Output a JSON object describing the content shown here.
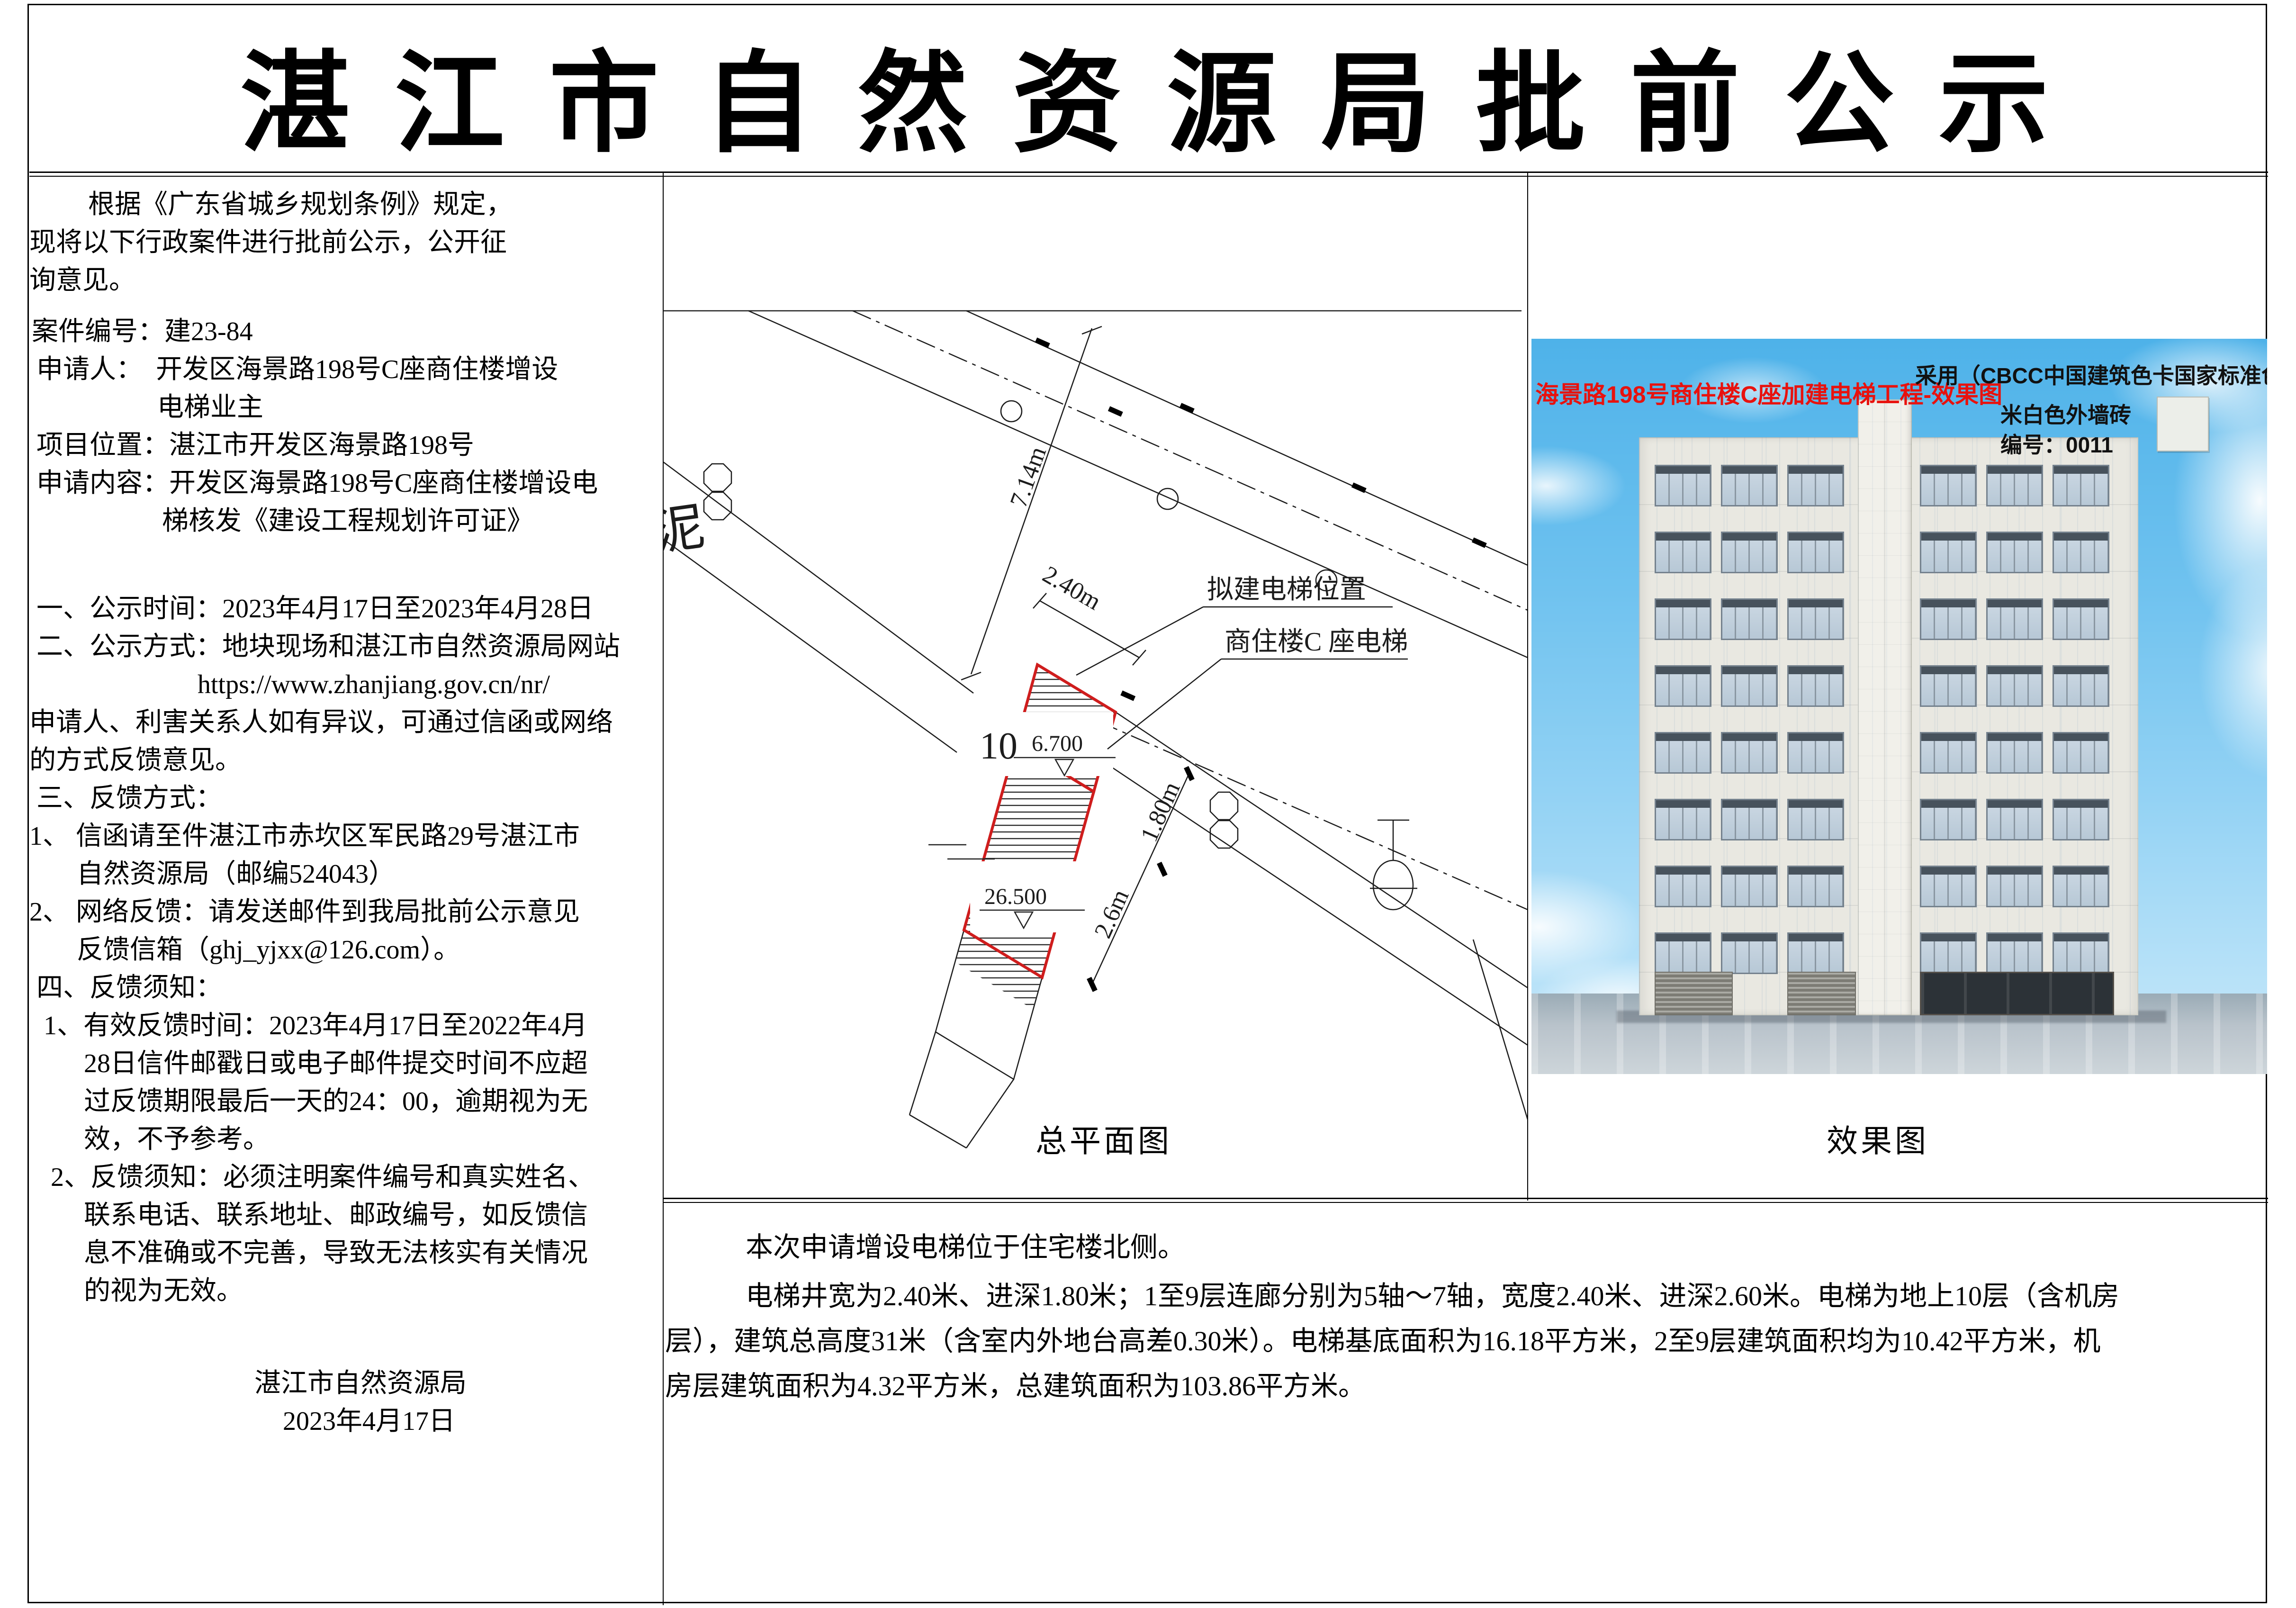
{
  "page": {
    "title": "湛 江 市 自 然 资 源 局 批 前 公 示"
  },
  "left_panel": {
    "lines": [
      {
        "t": "根据《广东省城乡规划条例》规定，",
        "ind": 124,
        "gap": 0
      },
      {
        "t": "现将以下行政案件进行批前公示，公开征",
        "ind": 0,
        "gap": 0
      },
      {
        "t": "询意见。",
        "ind": 0,
        "gap": 0
      },
      {
        "t": "案件编号：建23-84",
        "ind": 5,
        "gap": 28
      },
      {
        "t": "申请人：　开发区海景路198号C座商住楼增设",
        "ind": 15,
        "gap": 0
      },
      {
        "t": "电梯业主",
        "ind": 270,
        "gap": 0
      },
      {
        "t": "项目位置：湛江市开发区海景路198号",
        "ind": 15,
        "gap": 0
      },
      {
        "t": "申请内容：开发区海景路198号C座商住楼增设电",
        "ind": 15,
        "gap": 0
      },
      {
        "t": "梯核发《建设工程规划许可证》",
        "ind": 280,
        "gap": 0
      },
      {
        "t": "一、公示时间：2023年4月17日至2023年4月28日",
        "ind": 15,
        "gap": 105
      },
      {
        "t": "二、公示方式：地块现场和湛江市自然资源局网站",
        "ind": 15,
        "gap": 0
      },
      {
        "t": "https://www.zhanjiang.gov.cn/nr/",
        "ind": 355,
        "gap": 0
      },
      {
        "t": "申请人、利害关系人如有异议，可通过信函或网络",
        "ind": 0,
        "gap": 0
      },
      {
        "t": "的方式反馈意见。",
        "ind": 0,
        "gap": 0
      },
      {
        "t": "三、反馈方式：",
        "ind": 15,
        "gap": 0
      },
      {
        "t": "1、 信函请至件湛江市赤坎区军民路29号湛江市",
        "ind": 0,
        "gap": 0
      },
      {
        "t": "自然资源局（邮编524043）",
        "ind": 100,
        "gap": 0
      },
      {
        "t": "2、 网络反馈：请发送邮件到我局批前公示意见",
        "ind": 0,
        "gap": 0
      },
      {
        "t": "反馈信箱（ghj_yjxx@126.com）。",
        "ind": 100,
        "gap": 0
      },
      {
        "t": "四、反馈须知：",
        "ind": 15,
        "gap": 0
      },
      {
        "t": "1、有效反馈时间：2023年4月17日至2022年4月",
        "ind": 30,
        "gap": 0
      },
      {
        "t": "28日信件邮戳日或电子邮件提交时间不应超",
        "ind": 115,
        "gap": 0
      },
      {
        "t": "过反馈期限最后一天的24：00，逾期视为无",
        "ind": 115,
        "gap": 0
      },
      {
        "t": "效，不予参考。",
        "ind": 115,
        "gap": 0
      },
      {
        "t": "2、反馈须知：必须注明案件编号和真实姓名、",
        "ind": 45,
        "gap": 0
      },
      {
        "t": "联系电话、联系地址、邮政编号，如反馈信",
        "ind": 115,
        "gap": 0
      },
      {
        "t": "息不准确或不完善，导致无法核实有关情况",
        "ind": 115,
        "gap": 0
      },
      {
        "t": "的视为无效。",
        "ind": 115,
        "gap": 0
      },
      {
        "t": "湛江市自然资源局",
        "ind": 475,
        "gap": 115
      },
      {
        "t": "2023年4月17日",
        "ind": 535,
        "gap": 0
      }
    ]
  },
  "site_plan": {
    "caption": "总平面图",
    "cement_label": "泥",
    "label_elevator_location": "拟建电梯位置",
    "label_building_elevator": "商住楼C 座电梯",
    "dim_714": "7.14m",
    "dim_240": "2.40m",
    "dim_180": "1.80m",
    "dim_26": "2.6m",
    "floors_num": "10",
    "level_6700": "6.700",
    "level_26500": "26.500"
  },
  "rendering": {
    "caption": "效果图",
    "red_title": "海景路198号商住楼C座加建电梯工程-效果图",
    "color_note": "采用（CBCC中国建筑色卡国家标准色卡0011色）",
    "wall_note": "米白色外墙砖",
    "code_note": "编号：0011",
    "colors": {
      "sky": "#4eb2e9",
      "wall": "#e9e8e1",
      "accent_red": "#e8120e",
      "plan_red": "#cf1d1d"
    }
  },
  "bottom_panel": {
    "lines": [
      {
        "t": "本次申请增设电梯位于住宅楼北侧。",
        "ind": 170,
        "gap": 0
      },
      {
        "t": "电梯井宽为2.40米、进深1.80米；1至9层连廊分别为5轴～7轴，宽度2.40米、进深2.60米。电梯为地上10层（含机房",
        "ind": 170,
        "gap": 8
      },
      {
        "t": "层），建筑总高度31米（含室内外地台高差0.30米）。电梯基底面积为16.18平方米，2至9层建筑面积均为10.42平方米，机",
        "ind": 0,
        "gap": 0
      },
      {
        "t": "房层建筑面积为4.32平方米，总建筑面积为103.86平方米。",
        "ind": 0,
        "gap": 0
      }
    ]
  }
}
